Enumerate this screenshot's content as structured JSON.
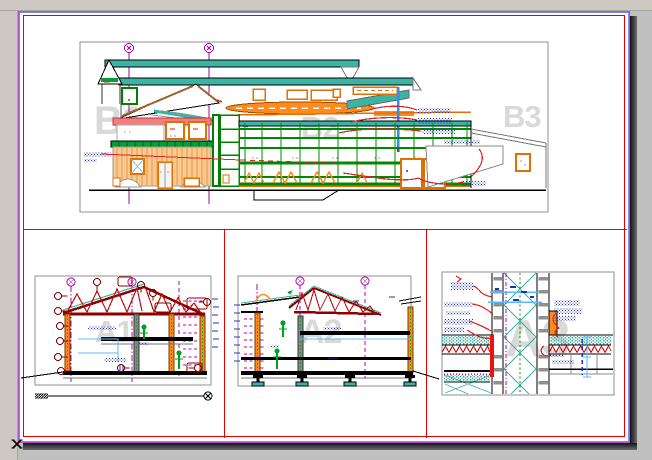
{
  "window": {
    "background": "#c0c0c0",
    "toolbar_strip": "#cdc9c2",
    "page_shadow": "#141414"
  },
  "sheet": {
    "fill": "#ffffff",
    "edge_outer": "#b04fd0",
    "edge_inner": "#8585f5",
    "frame_color": "#e60000",
    "panel_border": "#8f8f8f"
  },
  "watermarks": {
    "b1": "B1",
    "b2": "B2",
    "b3": "B3",
    "a1": "A1",
    "a2": "A2",
    "a3": "A3"
  },
  "icons": {
    "corner_marker": "x-cross-icon",
    "grid_marker": "grid-bubble-circle",
    "section_marker": "circle-with-cross"
  },
  "palette": {
    "teal_roof": "#3cb4a4",
    "orange": "#ff8a1e",
    "light_orange_wall": "#f9c98f",
    "salmon_band": "#f08080",
    "curtain_green": "#008800",
    "canopy_green": "#00a033",
    "truss_dark_red": "#8b0000",
    "leader_red": "#dd2222",
    "grid_magenta": "#b400b4",
    "note_blue": "#2233bb",
    "dim_light_blue": "#5bb8ff",
    "pipe_blue": "#2e8bff",
    "watermark_gray": "#d9d9d9"
  }
}
